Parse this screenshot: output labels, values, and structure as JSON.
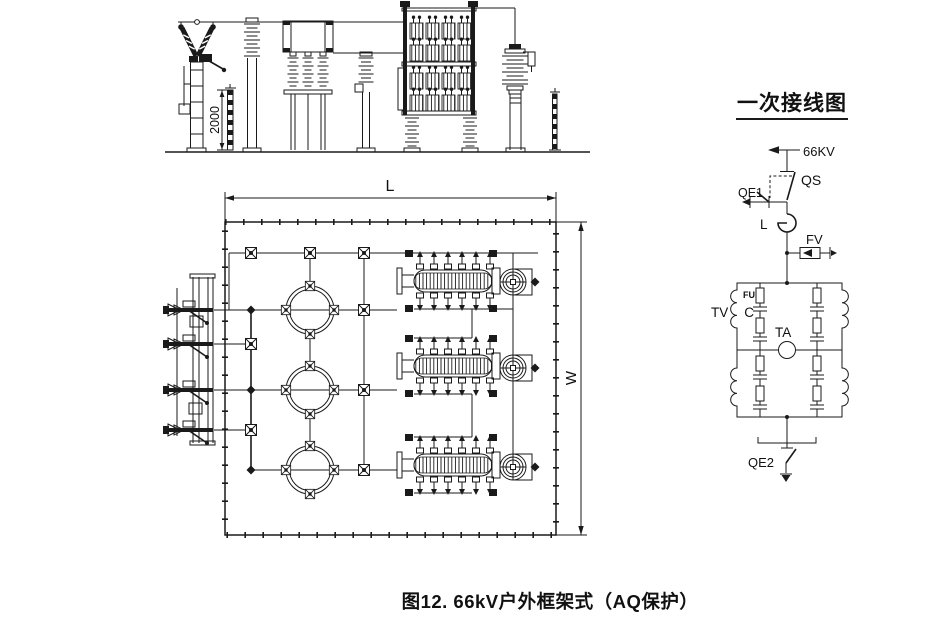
{
  "caption": "图12. 66kV户外框架式（AQ保护）",
  "elevation": {
    "height_dim": "2000"
  },
  "plan": {
    "length_dim": "L",
    "width_dim": "W"
  },
  "wiring": {
    "title": "一次接线图",
    "labels": {
      "voltage": "66KV",
      "disconnector": "QS",
      "earth_switch_1": "QE1",
      "reactor": "L",
      "arrester": "FV",
      "voltage_transformer": "TV",
      "fuse": "FU",
      "capacitor": "C",
      "current_transformer": "TA",
      "earth_switch_2": "QE2"
    }
  },
  "colors": {
    "line": "#1a1a1a",
    "background": "#ffffff"
  }
}
